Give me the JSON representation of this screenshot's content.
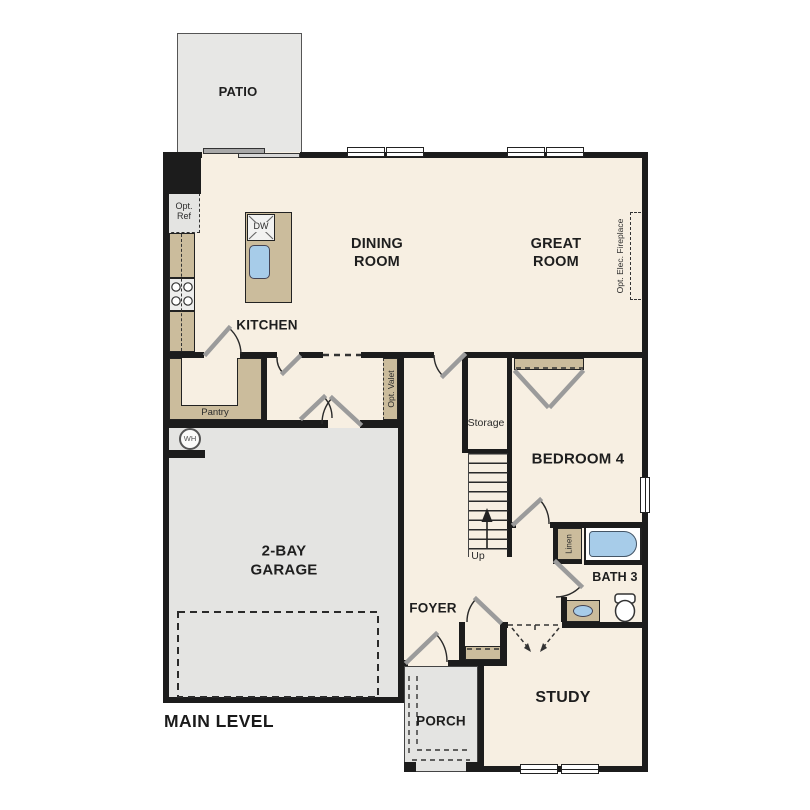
{
  "plan": {
    "level_label": "MAIN LEVEL",
    "rooms": {
      "patio": "PATIO",
      "dining_room": "DINING\nROOM",
      "great_room": "GREAT\nROOM",
      "kitchen": "KITCHEN",
      "bedroom_4": "BEDROOM 4",
      "bath_3": "BATH 3",
      "study": "STUDY",
      "foyer": "FOYER",
      "porch": "PORCH",
      "garage": "2-BAY\nGARAGE"
    },
    "annotations": {
      "pantry": "Pantry",
      "storage": "Storage",
      "up": "Up",
      "linen": "Linen",
      "opt_ref": "Opt.\nRef",
      "opt_valet": "Opt. Valet",
      "opt_elec_fireplace": "Opt. Elec. Fireplace",
      "water_heater": "WH",
      "dishwasher": "DW"
    },
    "colors": {
      "wall": "#1c1c1c",
      "floor": "#f7efe2",
      "hardscape": "#e4e4e2",
      "casework": "#cbbc9c",
      "fixture_blue": "#a7cce9"
    }
  }
}
